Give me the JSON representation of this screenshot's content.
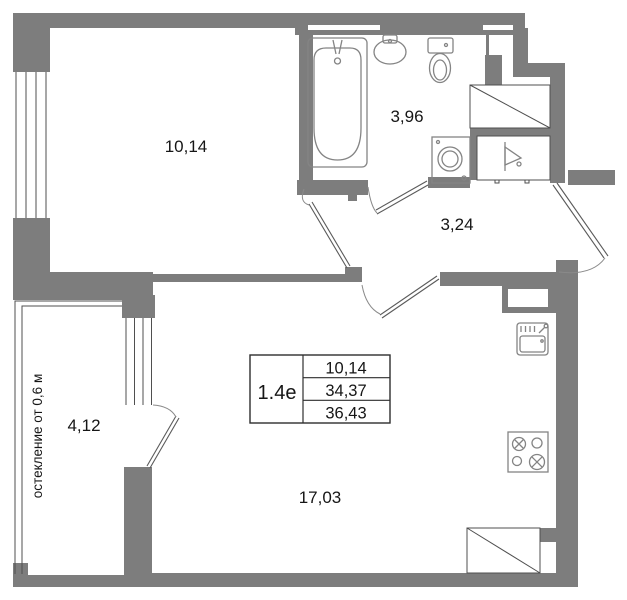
{
  "rooms": {
    "bedroom": {
      "area": "10,14"
    },
    "bathroom": {
      "area": "3,96"
    },
    "hallway": {
      "area": "3,24"
    },
    "balcony": {
      "area": "4,12"
    },
    "living_kitchen": {
      "area": "17,03"
    }
  },
  "info_table": {
    "unit": "1.4е",
    "values": [
      "10,14",
      "34,37",
      "36,43"
    ]
  },
  "balcony_note": "остекление от 0,6 м",
  "icons": [
    "bathtub-icon",
    "washbasin-icon",
    "toilet-icon",
    "washing-machine-icon",
    "wardrobe-icon",
    "vent-shaft-icon",
    "kitchen-sink-icon",
    "stove-icon",
    "closet-diagonal-icon",
    "door-swing-icon",
    "window-glazing-icon"
  ],
  "colors": {
    "wall": "#7d7d7d",
    "line": "#4f4f4f",
    "fixture": "#848484",
    "text": "#161616",
    "background": "#ffffff"
  }
}
